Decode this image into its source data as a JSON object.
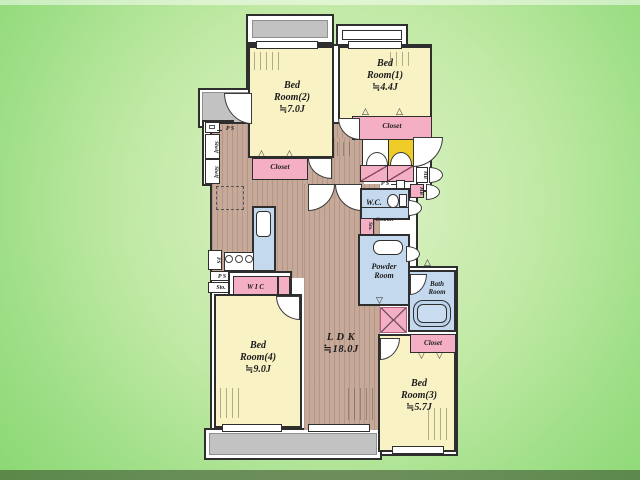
{
  "rooms": {
    "bedroom1": {
      "label": "Bed\nRoom(1)\n≒4.4J"
    },
    "bedroom2": {
      "label": "Bed\nRoom(2)\n≒7.0J"
    },
    "bedroom3": {
      "label": "Bed\nRoom(3)\n≒5.7J"
    },
    "bedroom4": {
      "label": "Bed\nRoom(4)\n≒9.0J"
    },
    "ldk": {
      "label": "L D K\n≒18.0J"
    },
    "wc": {
      "label": "W.C."
    },
    "powder_room": {
      "label": "Powder\nRoom"
    },
    "bath_room": {
      "label": "Bath\nRoom"
    }
  },
  "fixtures": {
    "closet": "Closet",
    "wic": "W I C",
    "shelf": "Shelf",
    "sto": "Sto.",
    "ps": "P S",
    "ps_short": "PS",
    "mb": "MB",
    "counter": "Counter"
  },
  "colors": {
    "background_green": "#a9e38f",
    "wall": "#2e2e2e",
    "room_yellow": "#f8f2c5",
    "closet_pink": "#f5afc5",
    "wet_area_blue": "#c5d9ee",
    "wood_floor": "#c7a99a",
    "entrance_tile": "#f0cc29",
    "balcony_gray": "#c2c2c2"
  }
}
